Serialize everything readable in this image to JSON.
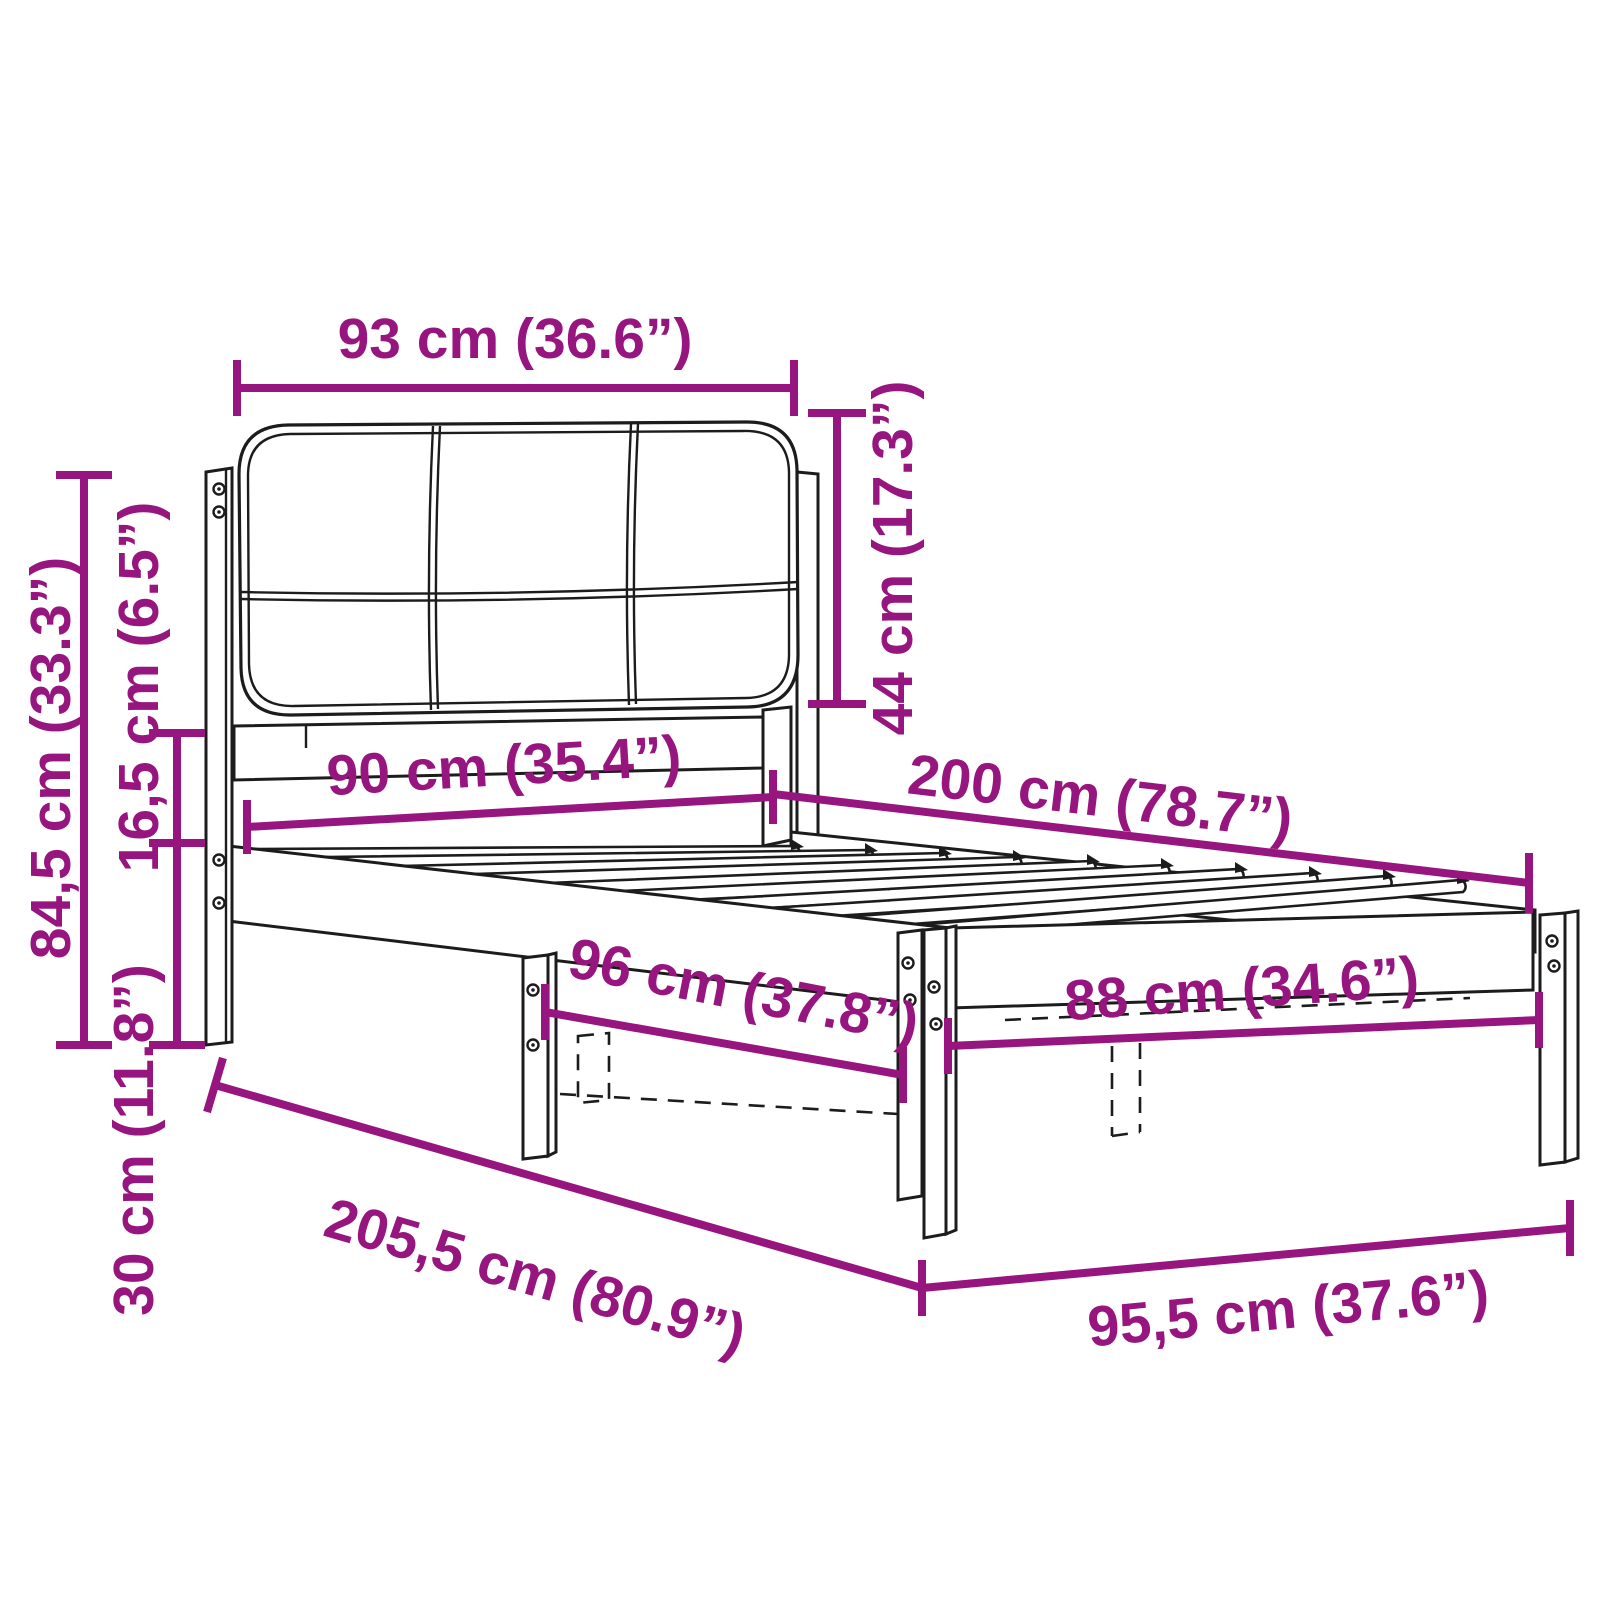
{
  "diagram": {
    "kind": "furniture-dimension-diagram",
    "subject": "single bed frame with upholstered headboard and slatted base",
    "colors": {
      "dimension": "#97157E",
      "outline": "#1C1C1C",
      "background": "#FFFFFF"
    },
    "dimensions": [
      {
        "id": "headboard-width",
        "label": "93 cm (36.6”)"
      },
      {
        "id": "headboard-height",
        "label": "44 cm (17.3”)"
      },
      {
        "id": "total-height",
        "label": "84,5 cm (33.3”)"
      },
      {
        "id": "headboard-frame-gap",
        "label": "16,5 cm (6.5”)"
      },
      {
        "id": "base-height",
        "label": "30 cm (11.8”)"
      },
      {
        "id": "bed-width",
        "label": "90 cm (35.4”)"
      },
      {
        "id": "bed-length",
        "label": "200 cm (78.7”)"
      },
      {
        "id": "side-outer-width",
        "label": "96 cm (37.8”)"
      },
      {
        "id": "foot-inner-width",
        "label": "88 cm (34.6”)"
      },
      {
        "id": "total-length",
        "label": "205,5 cm (80.9”)"
      },
      {
        "id": "total-width",
        "label": "95,5 cm (37.6”)"
      }
    ]
  }
}
